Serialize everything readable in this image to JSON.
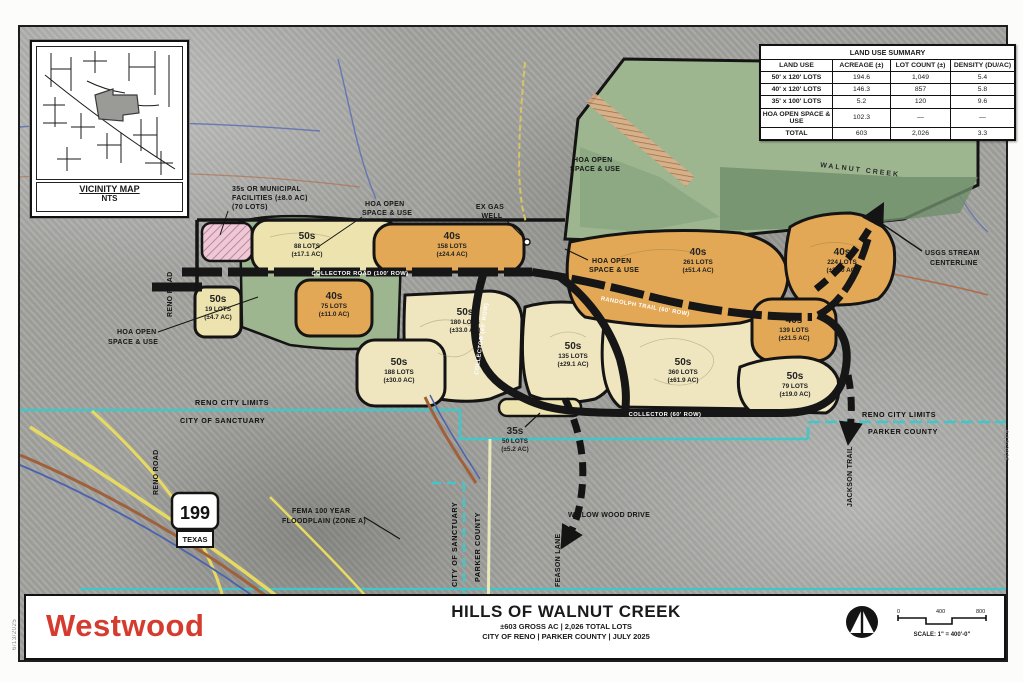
{
  "vicinity": {
    "title": "VICINITY MAP",
    "nts": "NTS"
  },
  "summary_table": {
    "title": "LAND USE SUMMARY",
    "columns": [
      "LAND USE",
      "ACREAGE (±)",
      "LOT COUNT (±)",
      "DENSITY (DU/AC)"
    ],
    "rows": [
      {
        "land_use": "50' x 120' LOTS",
        "acreage": "194.6",
        "lots": "1,049",
        "density": "5.4"
      },
      {
        "land_use": "40' x 120' LOTS",
        "acreage": "146.3",
        "lots": "857",
        "density": "5.8"
      },
      {
        "land_use": "35' x 100' LOTS",
        "acreage": "5.2",
        "lots": "120",
        "density": "9.6"
      },
      {
        "land_use": "HOA OPEN SPACE & USE",
        "acreage": "102.3",
        "lots": "—",
        "density": "—"
      },
      {
        "land_use": "TOTAL",
        "acreage": "603",
        "lots": "2,026",
        "density": "3.3"
      }
    ]
  },
  "parcels": [
    {
      "size": "50s",
      "lots": "88 LOTS",
      "acres": "(±17.1 AC)"
    },
    {
      "size": "50s",
      "lots": "19 LOTS",
      "acres": "(±4.7 AC)"
    },
    {
      "size": "40s",
      "lots": "75 LOTS",
      "acres": "(±11.0 AC)"
    },
    {
      "size": "40s",
      "lots": "158 LOTS",
      "acres": "(±24.4 AC)"
    },
    {
      "size": "50s",
      "lots": "180 LOTS",
      "acres": "(±33.0 AC)"
    },
    {
      "size": "50s",
      "lots": "188 LOTS",
      "acres": "(±30.0 AC)"
    },
    {
      "size": "50s",
      "lots": "135 LOTS",
      "acres": "(±29.1 AC)"
    },
    {
      "size": "50s",
      "lots": "360 LOTS",
      "acres": "(±61.9 AC)"
    },
    {
      "size": "40s",
      "lots": "261 LOTS",
      "acres": "(±51.4 AC)"
    },
    {
      "size": "40s",
      "lots": "224 LOTS",
      "acres": "(±38.0 AC)"
    },
    {
      "size": "40s",
      "lots": "139 LOTS",
      "acres": "(±21.5 AC)"
    },
    {
      "size": "50s",
      "lots": "79 LOTS",
      "acres": "(±19.0 AC)"
    },
    {
      "size": "35s",
      "lots": "50 LOTS",
      "acres": "(±5.2 AC)"
    }
  ],
  "labels": {
    "municipal": {
      "l1": "35s OR MUNICIPAL",
      "l2": "FACILITIES (±8.0 AC)",
      "l3": "(70 LOTS)"
    },
    "hoa": {
      "l1": "HOA OPEN",
      "l2": "SPACE & USE"
    },
    "ex_gas": {
      "l1": "EX GAS",
      "l2": "WELL"
    },
    "walnut_creek": "WALNUT CREEK",
    "usgs": {
      "l1": "USGS STREAM",
      "l2": "CENTERLINE"
    },
    "fema": {
      "l1": "FEMA 100 YEAR",
      "l2": "FLOODPLAIN (ZONE A)"
    }
  },
  "boundaries": {
    "reno_city_limits": "RENO CITY LIMITS",
    "city_of_sanctuary": "CITY OF SANCTUARY",
    "parker_county": "PARKER COUNTY"
  },
  "roads": {
    "main_road": "COLLECTOR ROAD (100' ROW)",
    "ne_road": "RANDOLPH TRAIL (60' ROW)",
    "loop_road": "COLLECTOR (60' ROW)",
    "south_road": "COLLECTOR (60' ROW)",
    "reno_road": "RENO ROAD",
    "jackson_trail": "JACKSON TRAIL",
    "willow_wood": "WILLOW WOOD DRIVE",
    "feason_lane": "FEASON LANE"
  },
  "shield": {
    "route": "199",
    "state": "TEXAS"
  },
  "title_block": {
    "company": "Westwood",
    "title": "HILLS OF WALNUT CREEK",
    "subtitle": "±603 GROSS AC | 2,026 TOTAL LOTS",
    "subtitle2": "CITY OF RENO | PARKER COUNTY | JULY 2025",
    "scale_label": "SCALE: 1\" = 400'-0\"",
    "scale_ticks": [
      "0",
      "400",
      "800"
    ]
  },
  "edge_notes": {
    "right": "6/13/2025",
    "left": "6/13/2025"
  },
  "colors": {
    "westwood_red": "#d63b2f",
    "boundary_cyan": "#41c7c8",
    "lots_50_fill": "#ede3ae",
    "lots_40_fill": "#e3a855",
    "lots_35_fill": "#ecc9d5",
    "open_space_fill": "#9eb690",
    "road_black": "#161616"
  }
}
